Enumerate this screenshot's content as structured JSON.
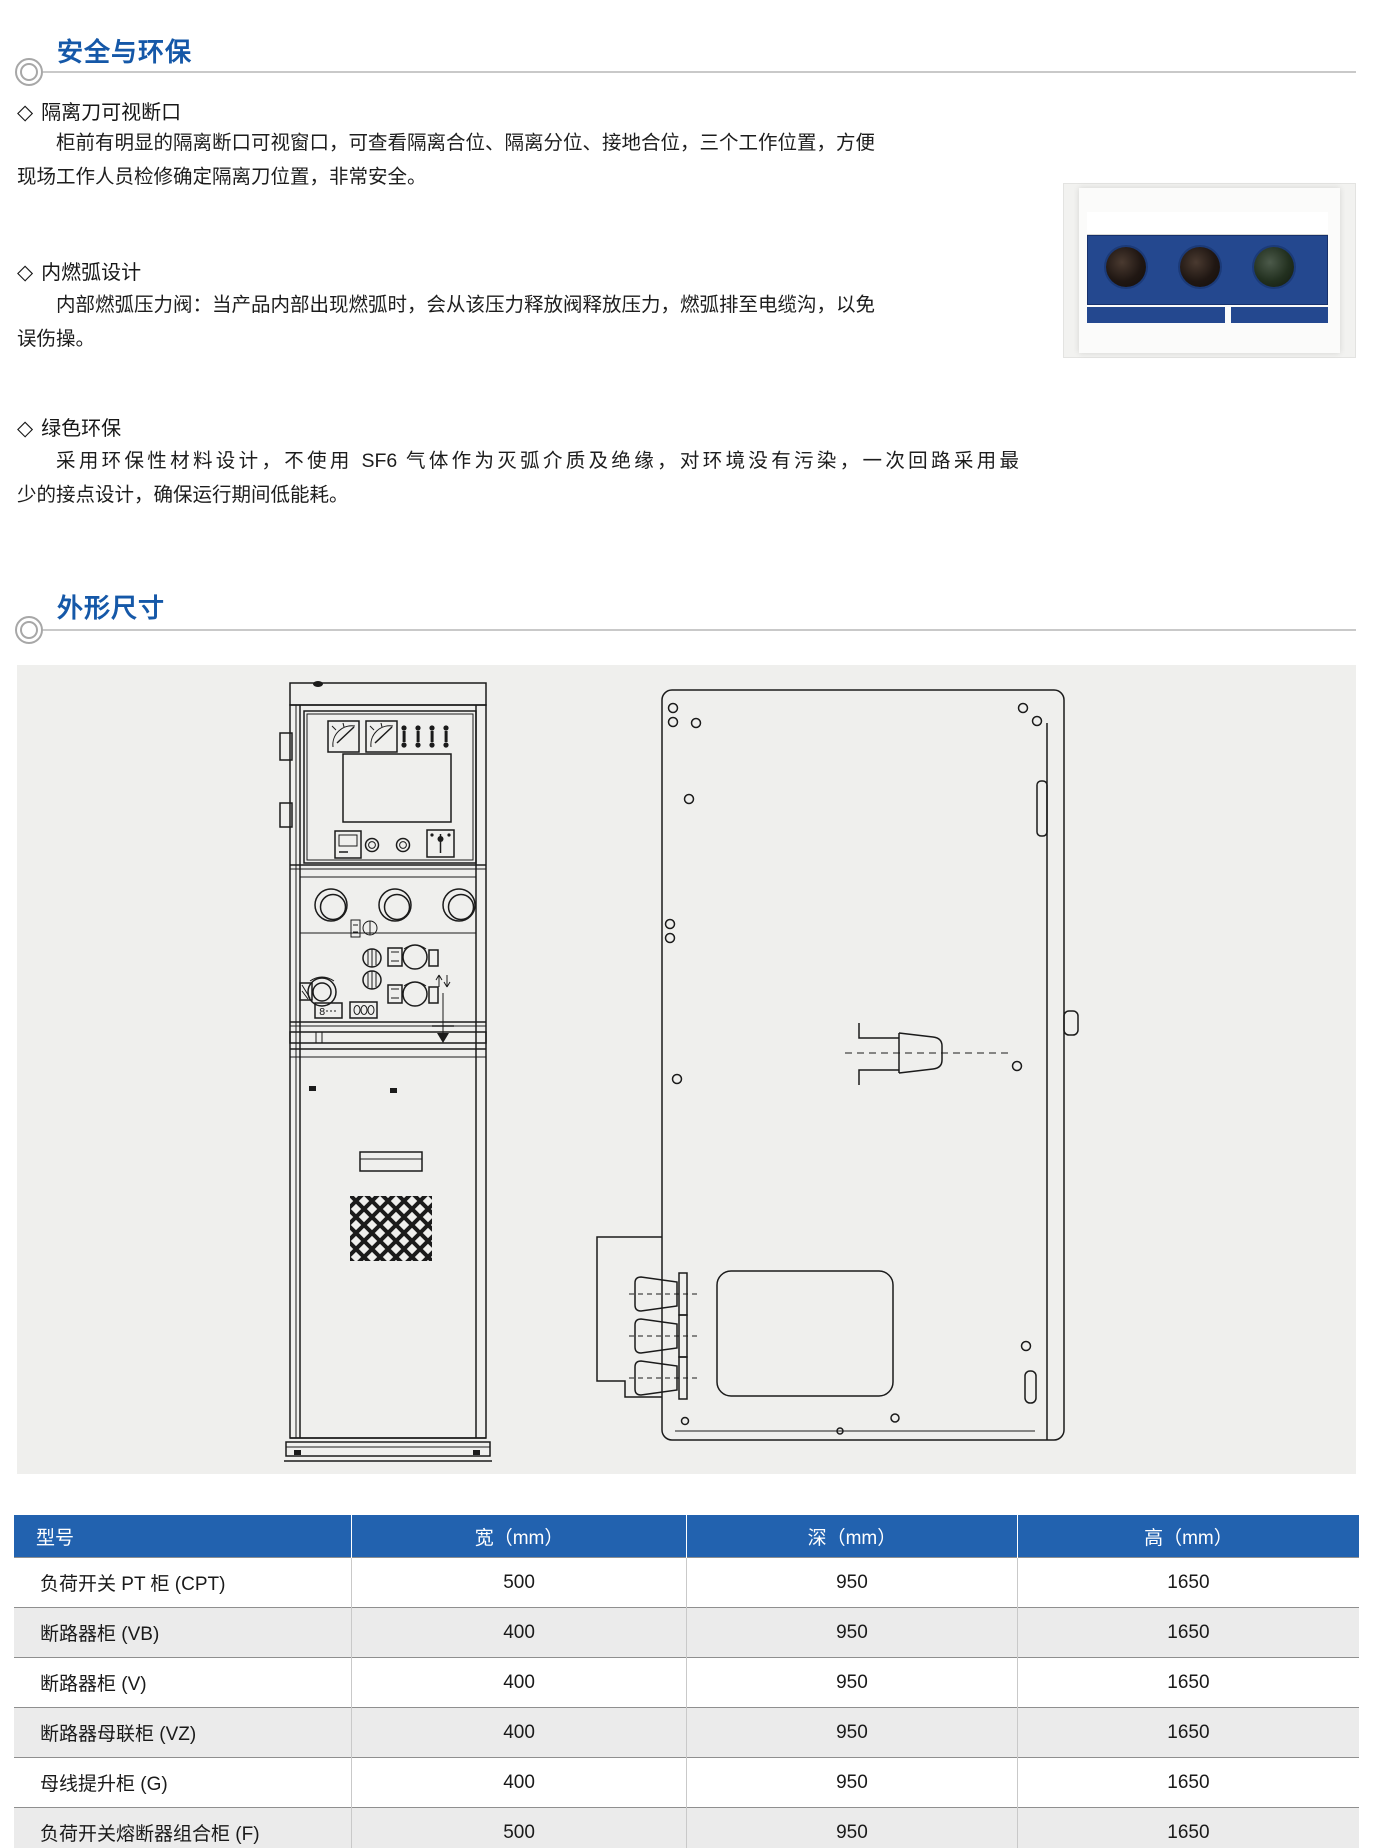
{
  "colors": {
    "title_blue": "#1558a8",
    "table_header_bg": "#2262af",
    "photo_navy": "#24488f",
    "panel_gray": "#efefed"
  },
  "safety": {
    "title": "安全与环保",
    "items": [
      {
        "marker": "◇",
        "heading": "隔离刀可视断口",
        "lines": [
          "柜前有明显的隔离断口可视窗口，可查看隔离合位、隔离分位、接地合位，三个工作位置，方便",
          "现场工作人员检修确定隔离刀位置，非常安全。"
        ]
      },
      {
        "marker": "◇",
        "heading": "内燃弧设计",
        "lines": [
          "内部燃弧压力阀：当产品内部出现燃弧时，会从该压力释放阀释放压力，燃弧排至电缆沟，以免",
          "误伤操。"
        ]
      },
      {
        "marker": "◇",
        "heading": "绿色环保",
        "lines": [
          "采用环保性材料设计，不使用 SF6 气体作为灭弧介质及绝缘，对环境没有污染，一次回路采用最",
          "少的接点设计，确保运行期间低能耗。"
        ]
      }
    ]
  },
  "dimensions": {
    "title": "外形尺寸",
    "table": {
      "headers": [
        "型号",
        "宽（mm）",
        "深（mm）",
        "高（mm）"
      ],
      "rows": [
        [
          "负荷开关 PT 柜 (CPT)",
          "500",
          "950",
          "1650"
        ],
        [
          "断路器柜 (VB)",
          "400",
          "950",
          "1650"
        ],
        [
          "断路器柜 (V)",
          "400",
          "950",
          "1650"
        ],
        [
          "断路器母联柜 (VZ)",
          "400",
          "950",
          "1650"
        ],
        [
          "母线提升柜 (G)",
          "400",
          "950",
          "1650"
        ],
        [
          "负荷开关熔断器组合柜 (F)",
          "500",
          "950",
          "1650"
        ]
      ]
    }
  }
}
